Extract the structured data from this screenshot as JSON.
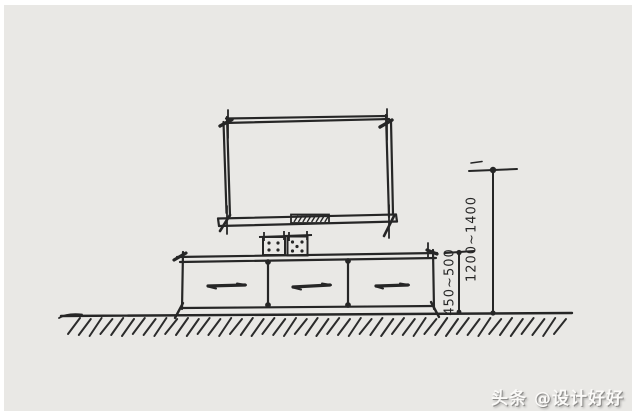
{
  "page": {
    "background_color": "#ffffff",
    "paper_color": "#e9e8e5",
    "ink_color": "#262626",
    "watermark_text_color": "#fbfaf8",
    "watermark_shadow_color": "#8f8e8c"
  },
  "sketch": {
    "dimensions": {
      "cabinet_height": "450~500",
      "tv_center_height": "1200~1400"
    },
    "watermark": "头条 @设计好好"
  }
}
